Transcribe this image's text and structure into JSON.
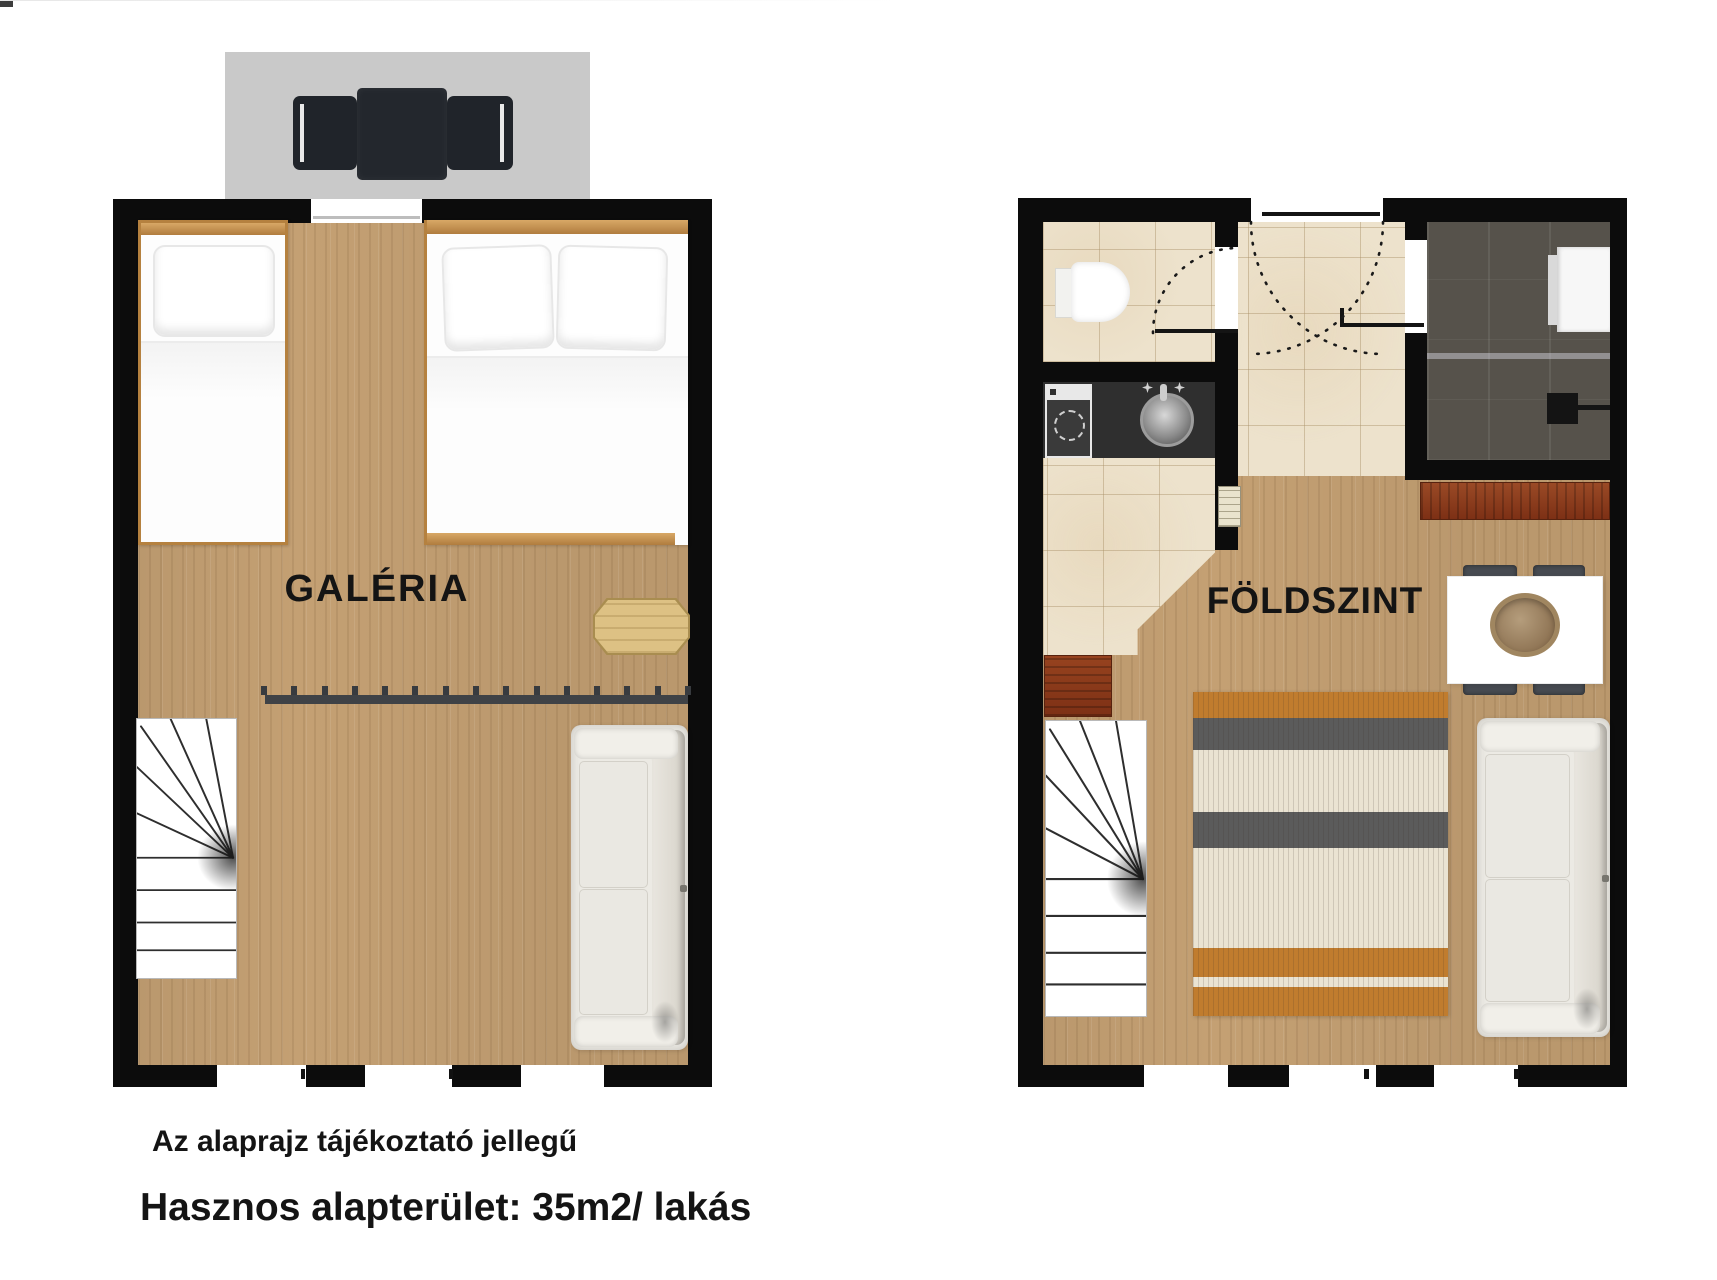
{
  "plans": {
    "upper": {
      "label": "GALÉRIA"
    },
    "ground": {
      "label": "FÖLDSZINT"
    }
  },
  "captions": {
    "disclaimer": "Az alaprajz tájékoztató jellegű",
    "usable_area": "Hasznos alapterület: 35m2/ lakás"
  },
  "colors": {
    "wall": "#0c0c0c",
    "wood_floor": "#c4a073",
    "tile_floor": "#ede2cc",
    "terrace": "#c9c9c9",
    "shower_dark": "#56524b",
    "counter_dark": "#2f2f2f",
    "cabinet_red": "#8e3c20",
    "rug_orange": "#c07c2e",
    "rug_gray": "#5b5b5b",
    "rug_cream": "#eae3d2",
    "sofa": "#eceae4",
    "railing": "#3f4246",
    "text": "#141414"
  },
  "furniture_icons": {
    "upper": [
      "outdoor-seating",
      "terrace",
      "single-bed",
      "double-bed",
      "side-table",
      "loft-railing",
      "winder-stairs",
      "sofa",
      "windows",
      "terrace-door"
    ],
    "ground": [
      "toilet",
      "bathroom-door",
      "entrance-door",
      "door-swing-arcs",
      "shower",
      "towel-shelf",
      "kitchen-counter",
      "washing-machine",
      "kitchen-sink",
      "faucet",
      "radiator",
      "wardrobe-cabinet",
      "winder-stairs",
      "striped-rug",
      "dining-table",
      "dining-chairs",
      "serving-bowl",
      "sideboard",
      "sofa",
      "windows"
    ]
  }
}
